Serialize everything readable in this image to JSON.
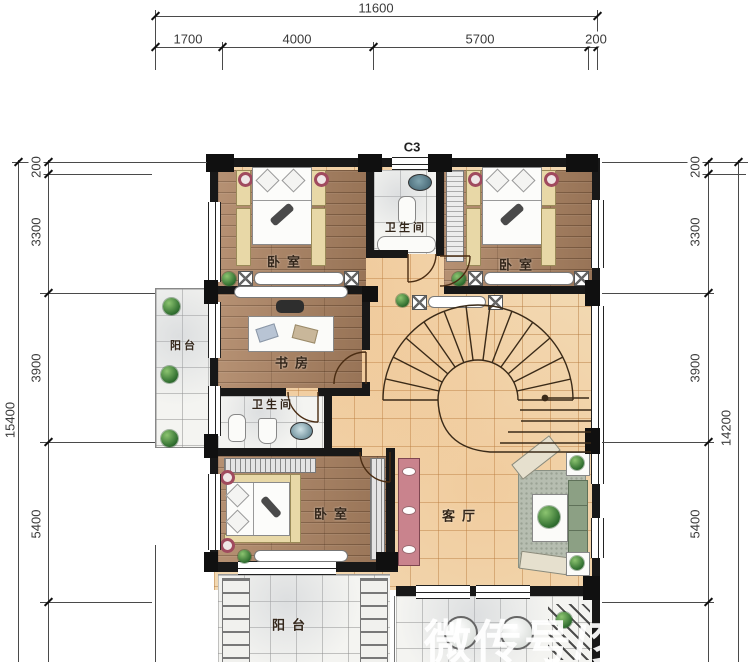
{
  "dimensions": {
    "top": {
      "total": "11600",
      "seg1": "1700",
      "seg2": "4000",
      "seg3": "5700",
      "seg4": "200"
    },
    "left": {
      "total": "15400",
      "seg1": "200",
      "seg2": "3300",
      "seg3": "3900",
      "seg4": "5400"
    },
    "right": {
      "total": "14200",
      "seg1": "200",
      "seg2": "3300",
      "seg3": "3900",
      "seg4": "5400"
    }
  },
  "labels": {
    "window_code": "C3",
    "bedroom_top_left": "卧室",
    "bedroom_top_right": "卧室",
    "bedroom_bottom": "卧室",
    "bathroom_top": "卫生间",
    "bathroom_middle": "卫生间",
    "study": "书房",
    "living_room": "客厅",
    "balcony_left": "阳台",
    "balcony_bottom": "阳台"
  },
  "watermark": "微传号/梦",
  "colors": {
    "wall": "#181818",
    "wood_floor": "#ad8463",
    "hall_tile": "#f2d8b1",
    "marble": "#f4f4f1",
    "accent_red": "#a04a5e"
  }
}
